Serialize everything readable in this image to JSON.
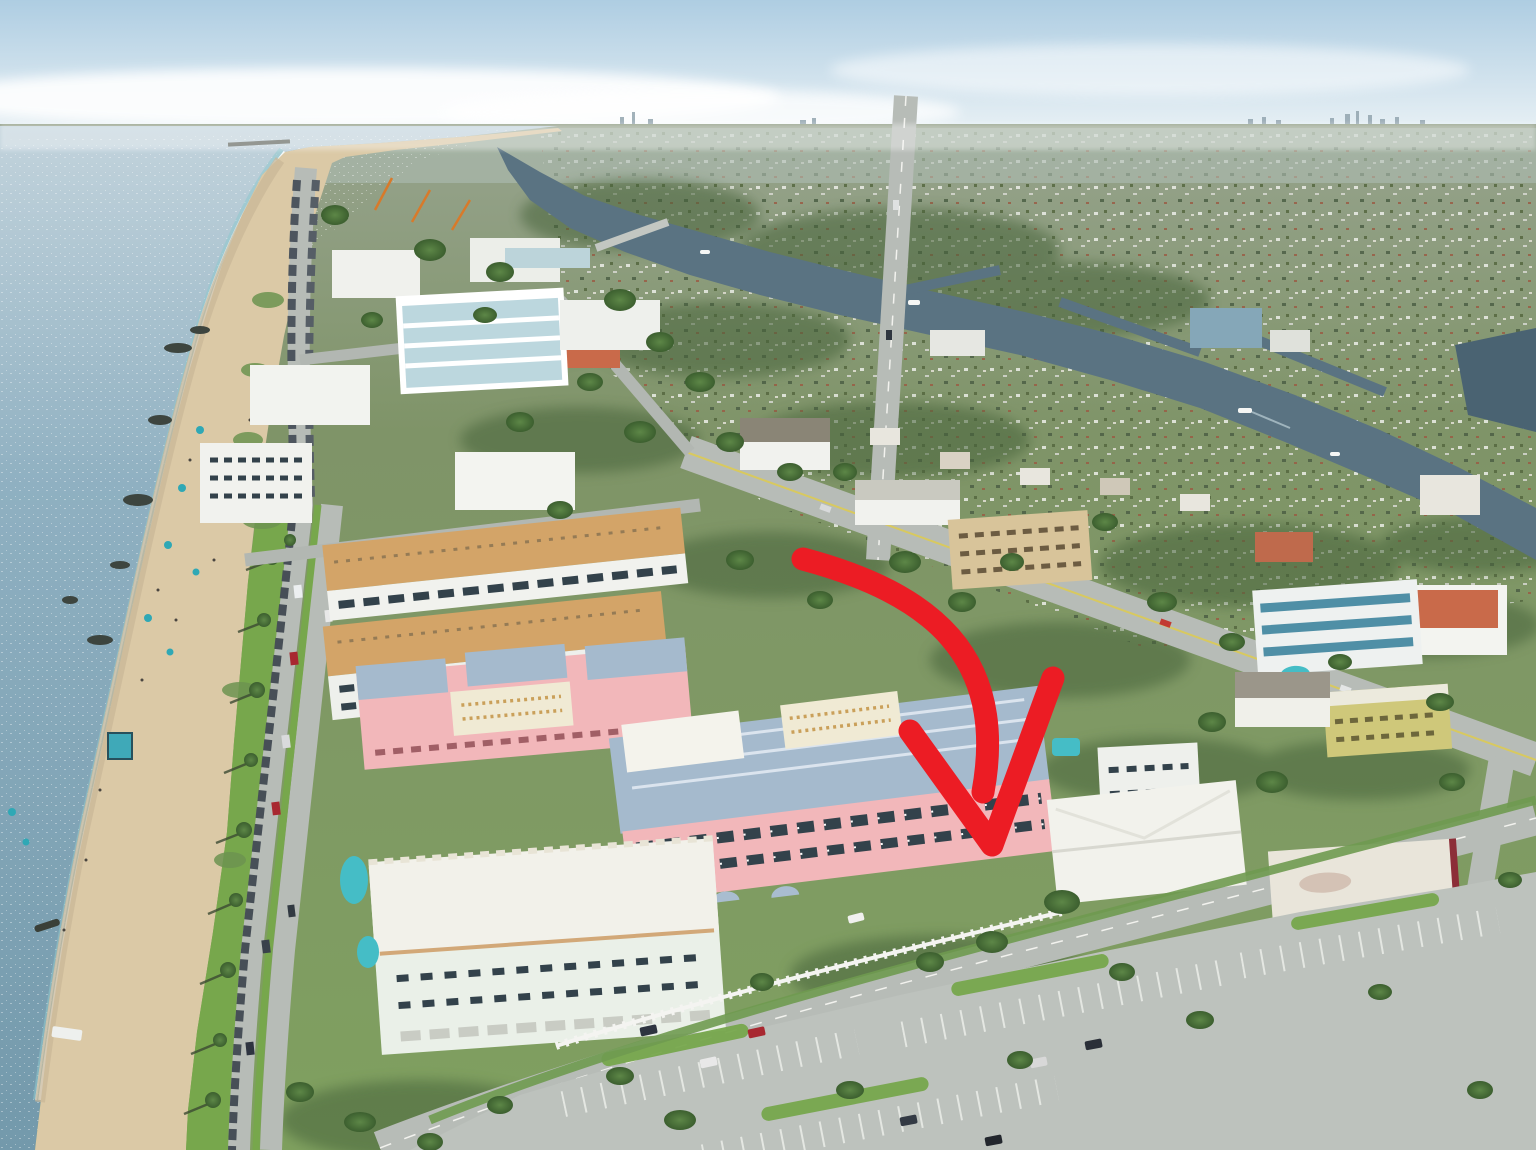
{
  "image": {
    "kind": "aerial-photograph",
    "subject": "oceanfront condominium complex highlighted by a red arrow",
    "setting": "South Florida barrier island: Atlantic Ocean and beach on the left, condo district in the middle, Intracoastal Waterway and suburbs on the right",
    "width_px": 1536,
    "height_px": 1150
  },
  "annotation": {
    "name": "listing-arrow",
    "shape": "thick curved swoosh with large V arrowhead pointing down at the subject building",
    "color": "#ec1c24"
  },
  "palette": {
    "sky_top": "#aecde2",
    "sky_horizon": "#e9f1f5",
    "cloud": "#ffffff",
    "sea_far": "#c2d3dc",
    "sea_mid": "#8fb0c1",
    "sea_near": "#7399ab",
    "surf_foam": "#ffffff",
    "shallow_water": "#8ec9cd",
    "sand": "#dbc9a6",
    "sand_wet": "#c9b697",
    "rock": "#3d453f",
    "grass": "#77a74c",
    "tree_light": "#5d8747",
    "tree_dark": "#3c5f2f",
    "land_far": "#97a38e",
    "land_mid": "#7f9468",
    "land_near": "#7fa05f",
    "road": "#b7bcb7",
    "road_line": "#f2f2ee",
    "yellow_line": "#d8c95f",
    "parking_lot": "#bdc2bd",
    "waterway": "#5a7382",
    "waterway_deep": "#4a6372",
    "white_building": "#f1f2ee",
    "building_shadow": "#9aa198",
    "window_dark": "#33424b",
    "tan_roof": "#d3a468",
    "pink_wall": "#f2b7ba",
    "blue_roof": "#a5bacd",
    "cream_deck": "#f0ead4",
    "mint_wall": "#eaf0e8",
    "beige_wall": "#d8c49a",
    "salmon_roof": "#c96a4a",
    "teal_band": "#4f8fa6",
    "teal_wall": "#8fc0ae",
    "maroon_trim": "#8c2e38",
    "pool_teal": "#45bdc6",
    "umbrella_teal": "#2fa8b5",
    "car_dark": "#39414b",
    "car_red": "#a82830",
    "car_silver": "#d9dadc",
    "crane_orange": "#d87a2a",
    "skyline": "#93a5af",
    "pier": "#5a5f58",
    "fence_white": "#f4f4f1"
  },
  "scene": {
    "regions": [
      "sky",
      "ocean",
      "beach",
      "dune-park",
      "beach-roads",
      "barrier-island-buildings",
      "subject-condo-complex",
      "intracoastal-waterway",
      "mainland-suburbs",
      "parking-lot"
    ],
    "subject_building": {
      "walls": "pink",
      "roof": "blue-gray metal hip roofs with white roof decks",
      "floors_visible": 5
    },
    "beach_items": {
      "umbrellas": 10,
      "rocks": 7,
      "lifeguard_hut_color": "#3fa9b8"
    },
    "boats_on_waterway": 4,
    "construction_cranes": 3
  }
}
